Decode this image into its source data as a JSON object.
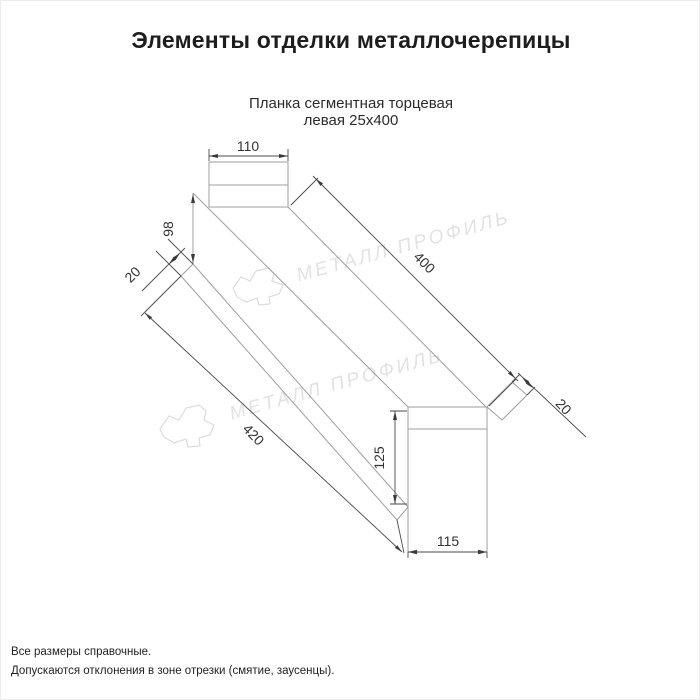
{
  "page": {
    "title": "Элементы отделки металлочерепицы"
  },
  "product": {
    "name_line1": "Планка сегментная торцевая",
    "name_line2": "левая 25х400"
  },
  "drawing": {
    "type": "technical-dimension-drawing",
    "dimensions": {
      "top_width_mm": "110",
      "near_end_height_mm": "98",
      "near_flange_mm": "20",
      "top_edge_length_mm": "400",
      "bottom_edge_length_mm": "420",
      "far_flange_mm": "20",
      "far_end_height_mm": "125",
      "far_end_width_mm": "115"
    },
    "watermark_text": "МЕТАЛЛ ПРОФИЛЬ"
  },
  "footnotes": {
    "line1": "Все размеры справочные.",
    "line2": "Допускаются отклонения в зоне отрезки (смятие, заусенцы)."
  },
  "colors": {
    "background": "#ffffff",
    "part_line": "#9e9e9e",
    "dimension_line": "#4a4a4a",
    "dimension_text": "#333333",
    "title_text": "#1d1d1d",
    "watermark": "#e2e2e2"
  }
}
